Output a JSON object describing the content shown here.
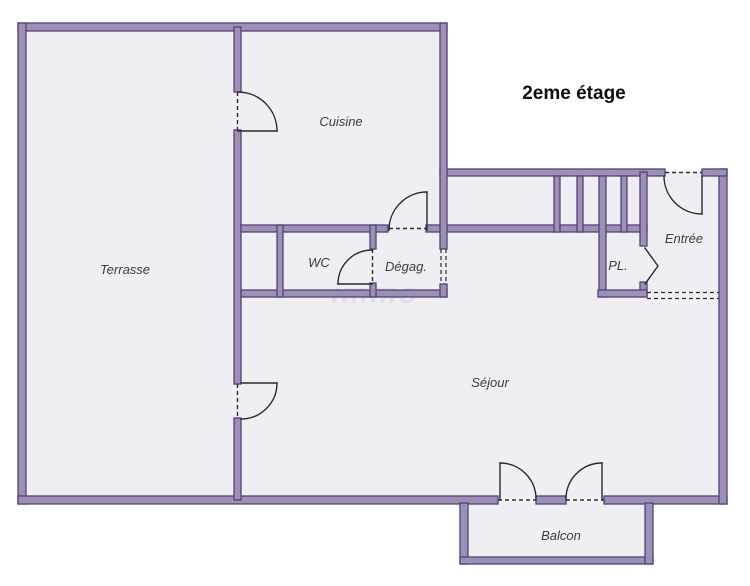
{
  "title": "2eme étage",
  "watermark": "immo",
  "rooms": {
    "terrasse": "Terrasse",
    "cuisine": "Cuisine",
    "wc": "WC",
    "degagement": "Dégag.",
    "placard": "PL.",
    "entree": "Entrée",
    "sejour": "Séjour",
    "balcon": "Balcon"
  },
  "colors": {
    "wall-fill": "#9c90ba",
    "wall-edge": "#54436f",
    "floor": "#efeef2",
    "door-line": "#2b2b2b",
    "label": "#3c3c3c",
    "title": "#0e0e0e",
    "watermark": "#d7d5dd"
  }
}
